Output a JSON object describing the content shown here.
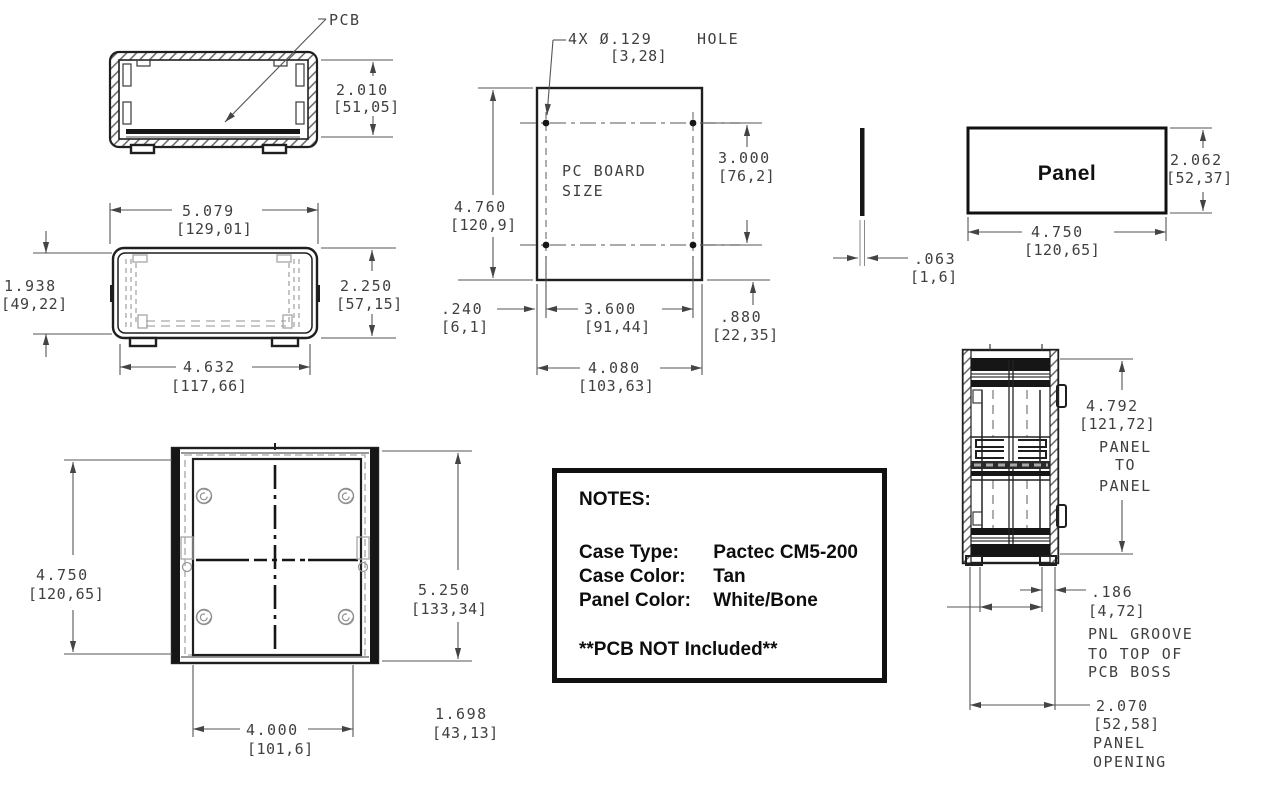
{
  "drawing_title": "Pactec CM5-200 enclosure dimensional drawing",
  "end_view": {
    "pcb_label": "PCB",
    "height_in": "2.010",
    "height_mm": "[51,05]"
  },
  "front_view": {
    "width_in": "5.079",
    "width_mm": "[129,01]",
    "inner_height_in": "1.938",
    "inner_height_mm": "[49,22]",
    "height_in": "2.250",
    "height_mm": "[57,15]",
    "inner_width_in": "4.632",
    "inner_width_mm": "[117,66]"
  },
  "pcb_view": {
    "hole_note_a": "4X Ø.129",
    "hole_note_b": "HOLE",
    "hole_note_mm": "[3,28]",
    "board_line1": "PC BOARD",
    "board_line2": "SIZE",
    "height_in": "4.760",
    "height_mm": "[120,9]",
    "hole_span_v_in": "3.000",
    "hole_span_v_mm": "[76,2]",
    "edge_offset_in": ".240",
    "edge_offset_mm": "[6,1]",
    "hole_span_h_in": "3.600",
    "hole_span_h_mm": "[91,44]",
    "bottom_offset_in": ".880",
    "bottom_offset_mm": "[22,35]",
    "width_in": "4.080",
    "width_mm": "[103,63]"
  },
  "panel_view": {
    "label": "Panel",
    "thickness_in": ".063",
    "thickness_mm": "[1,6]",
    "height_in": "2.062",
    "height_mm": "[52,37]",
    "width_in": "4.750",
    "width_mm": "[120,65]"
  },
  "top_view": {
    "inner_in": "4.750",
    "inner_mm": "[120,65]",
    "outer_in": "5.250",
    "outer_mm": "[133,34]",
    "boss_span_in": "4.000",
    "boss_span_mm": "[101,6]",
    "depth_in": "1.698",
    "depth_mm": "[43,13]"
  },
  "side_view": {
    "p2p_in": "4.792",
    "p2p_mm": "[121,72]",
    "p2p_l1": "PANEL",
    "p2p_l2": "TO",
    "p2p_l3": "PANEL",
    "groove_in": ".186",
    "groove_mm": "[4,72]",
    "groove_l1": "PNL GROOVE",
    "groove_l2": "TO TOP OF",
    "groove_l3": "PCB BOSS",
    "opening_in": "2.070",
    "opening_mm": "[52,58]",
    "opening_l1": "PANEL",
    "opening_l2": "OPENING"
  },
  "notes": {
    "title": "NOTES:",
    "rows": [
      {
        "label": "Case Type:",
        "value": "Pactec CM5-200"
      },
      {
        "label": "Case Color:",
        "value": "Tan"
      },
      {
        "label": "Panel Color:",
        "value": "White/Bone"
      }
    ],
    "footnote": "**PCB NOT Included**"
  }
}
